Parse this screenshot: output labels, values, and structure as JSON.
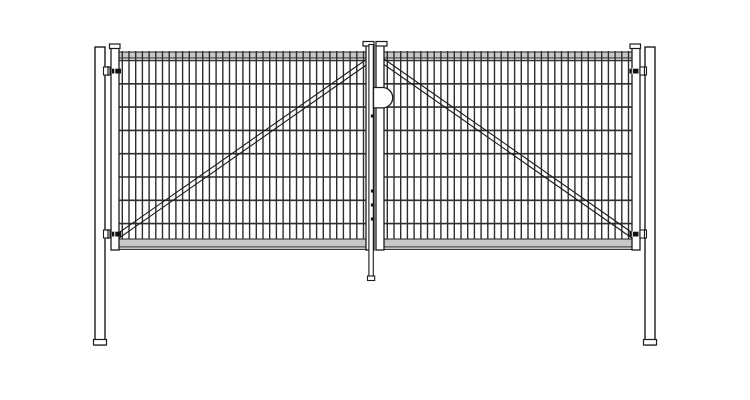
{
  "drawing": {
    "description_label": "double-leaf-mesh-gate-technical-drawing",
    "canvas": {
      "w": 750,
      "h": 400
    },
    "colors": {
      "background": "#ffffff",
      "line": "#1c1c1c",
      "wire": "#2e2e2e",
      "rail_fill": "#c8c8c8",
      "metal_fill": "#ffffff",
      "pin_fill": "#111111"
    },
    "posts": {
      "left_x": 95,
      "right_x": 645,
      "width": 10,
      "top": 47,
      "bottom": 345,
      "foot_h": 5.5,
      "foot_overhang": 1.5
    },
    "stile": {
      "w": 8,
      "top": 45,
      "bottom": 250
    },
    "rail": {
      "top_y": 52,
      "top_h": 6,
      "bottom_y": 239,
      "bottom_h": 8,
      "bottom_edge_y": 249.3
    },
    "mesh": {
      "v_spacing": 6.7,
      "v_inset": 3.3,
      "wire_w": 1.4,
      "wire_top": 51,
      "wire_bottom": 239,
      "h_wires_y": [
        60.5,
        83.8,
        107.1,
        130.4,
        153.7,
        177.0,
        200.3,
        223.6
      ]
    },
    "leaves": [
      {
        "side": "left",
        "stiles": [
          111,
          366
        ],
        "mesh_x0": 119,
        "mesh_x1": 366,
        "frame_x0": 111,
        "frame_x1": 374,
        "brace": {
          "x1": 117,
          "y1": 234,
          "x2": 367,
          "y2": 59,
          "offset": 5.5
        }
      },
      {
        "side": "right",
        "stiles": [
          376,
          632
        ],
        "mesh_x0": 384,
        "mesh_x1": 632,
        "frame_x0": 376,
        "frame_x1": 640,
        "brace": {
          "x1": 634,
          "y1": 234,
          "x2": 384,
          "y2": 59,
          "offset": 5.5
        }
      }
    ],
    "caps": [
      {
        "name": "left-outer-stile-cap",
        "x": 109.5,
        "y": 44,
        "w": 10.5,
        "h": 4.5
      },
      {
        "name": "left-center-stile-cap",
        "x": 363,
        "y": 41.5,
        "w": 11,
        "h": 4.5
      },
      {
        "name": "right-center-stile-cap",
        "x": 376,
        "y": 41.5,
        "w": 11,
        "h": 4.5
      },
      {
        "name": "right-outer-stile-cap",
        "x": 630,
        "y": 44,
        "w": 10.5,
        "h": 4.5
      }
    ],
    "hinges": [
      {
        "name": "left-top-hinge",
        "bracket_x": 103.5,
        "pin_x": 112,
        "y": 67,
        "bracket_w": 6.5,
        "bracket_h": 8,
        "pin_w": 9,
        "pin_h": 4.8
      },
      {
        "name": "left-bottom-hinge",
        "bracket_x": 103.5,
        "pin_x": 112,
        "y": 230,
        "bracket_w": 6.5,
        "bracket_h": 8,
        "pin_w": 9,
        "pin_h": 4.8
      },
      {
        "name": "right-top-hinge",
        "bracket_x": 640,
        "pin_x": 629.5,
        "y": 67,
        "bracket_w": 6.5,
        "bracket_h": 8,
        "pin_w": 9,
        "pin_h": 4.8
      },
      {
        "name": "right-bottom-hinge",
        "bracket_x": 640,
        "pin_x": 629.5,
        "y": 230,
        "bracket_w": 6.5,
        "bracket_h": 8,
        "pin_w": 9,
        "pin_h": 4.8
      }
    ],
    "latch": {
      "x": 373.5,
      "y": 87.5,
      "flat_w": 9,
      "r": 10.2
    },
    "drop_rod": {
      "x": 368.9,
      "w": 4.4,
      "top": 44.5,
      "bottom": 276,
      "foot_x": 367.5,
      "foot_w": 7.2,
      "foot_h": 4.5,
      "guide_x": 370.9,
      "guide_w": 2.8,
      "guide_h": 3,
      "guides_y": [
        114.5,
        189.5,
        203.5,
        217.5
      ]
    }
  }
}
